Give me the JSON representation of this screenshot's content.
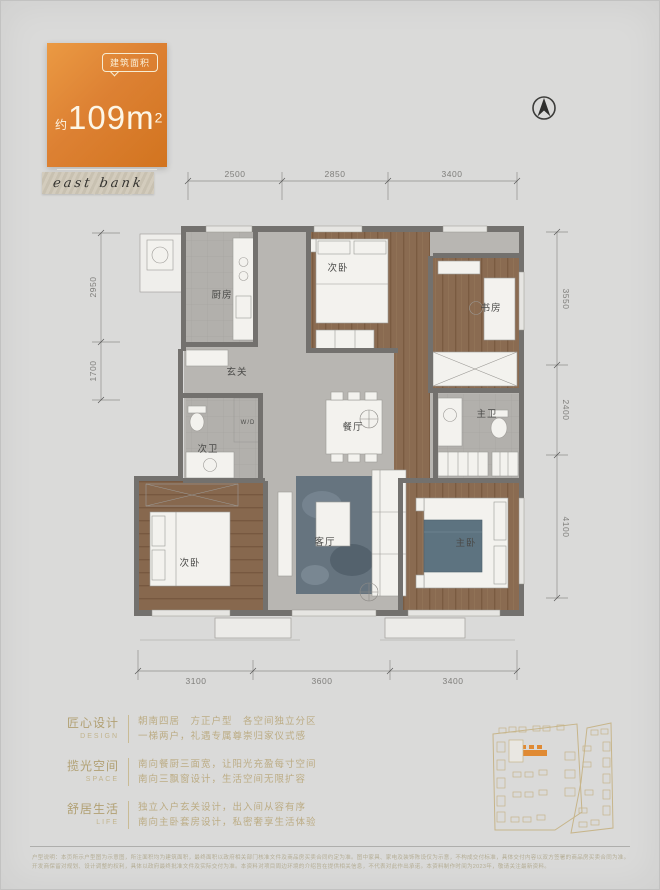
{
  "badge": {
    "tag": "建筑面积",
    "approx": "约",
    "area_number": "109m",
    "area_sup": "2",
    "layout_type": "·四室两厅两卫·"
  },
  "logo": {
    "text": "east bank"
  },
  "compass": {
    "icon": "north-arrow"
  },
  "plan": {
    "dims_top": [
      "2500",
      "2850",
      "3400"
    ],
    "dims_left": [
      "2950",
      "1700"
    ],
    "dims_right": [
      "3550",
      "2400",
      "4100"
    ],
    "dims_bottom": [
      "3100",
      "3600",
      "3400"
    ],
    "rooms": {
      "kitchen": "厨房",
      "bedroom2_top": "次卧",
      "study": "书房",
      "foyer": "玄关",
      "bath2": "次卫",
      "wd": "W/D",
      "dining": "餐厅",
      "master_bath": "主卫",
      "living": "客厅",
      "master_bedroom": "主卧",
      "bedroom2_bottom": "次卧"
    }
  },
  "features": [
    {
      "title": "匠心设计",
      "sub": "DESIGN",
      "line1": "朝南四居　方正户型　各空间独立分区",
      "line2": "一梯两户，礼遇专属尊崇归家仪式感"
    },
    {
      "title": "揽光空间",
      "sub": "SPACE",
      "line1": "南向餐厨三面宽，让阳光充盈每寸空间",
      "line2": "南向三飘窗设计，生活空间无限扩容"
    },
    {
      "title": "舒居生活",
      "sub": "LIFE",
      "line1": "独立入户玄关设计，出入间从容有序",
      "line2": "南向主卧套房设计，私密奢享生活体验"
    }
  ],
  "disclaimer": {
    "line1": "户型说明：本页所示户型图为示意图，所注面积均为建筑面积，最终面积以政府相关部门核准文件及商品房买卖合同约定为准。图中家具、家电及装饰陈设仅为示意，不构成交付标准，具体交付内容以双方签署的商品房买卖合同为准。",
    "line2": "开发商保留对规划、设计调整的权利，具体以政府最终批准文件及实际交付为准。本资料对项目周边环境的介绍旨在提供相关信息，不代表对此作出承诺。本资料制作时间为2023年，敬请关注最新资料。"
  },
  "colors": {
    "accent_orange": "#dd8133",
    "gold_text": "#bcac84",
    "wall_gray": "#73716e",
    "wood_brown": "#8a6b51",
    "rug_blue": "#66747f",
    "background": "#dadad9"
  }
}
